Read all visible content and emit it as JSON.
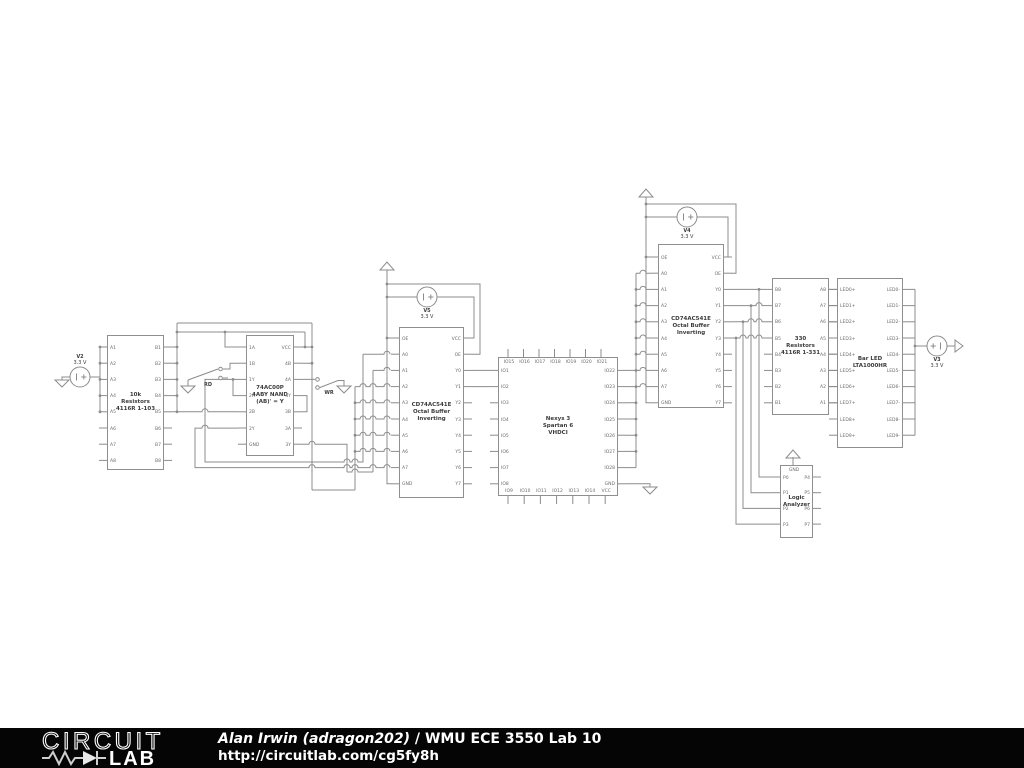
{
  "meta": {
    "background": "#ffffff",
    "wire_color": "#8c8c8c",
    "text_color": "#3c3c3c",
    "footer_bg": "#050505"
  },
  "footer": {
    "logo_top": "CIRCUIT",
    "logo_bottom": "LAB",
    "author": "Alan Irwin (adragon202)",
    "separator": " / ",
    "title": "WMU ECE 3550 Lab 10",
    "url": "http://circuitlab.com/cg5fy8h"
  },
  "sources": [
    {
      "id": "v2",
      "name": "V2",
      "value": "3.3 V",
      "cx": 80,
      "cy": 377,
      "label_side": "above",
      "plus": "right"
    },
    {
      "id": "v5",
      "name": "V5",
      "value": "3.3 V",
      "cx": 427,
      "cy": 297,
      "label_side": "below",
      "plus": "right"
    },
    {
      "id": "v4",
      "name": "V4",
      "value": "3.3 V",
      "cx": 687,
      "cy": 217,
      "label_side": "below",
      "plus": "right"
    },
    {
      "id": "v3",
      "name": "V3",
      "value": "3.3 V",
      "cx": 937,
      "cy": 346,
      "label_side": "below",
      "plus": "left"
    }
  ],
  "switches": [
    {
      "id": "rd",
      "label": "RD",
      "x": 208,
      "y": 382
    },
    {
      "id": "wr",
      "label": "WR",
      "x": 329,
      "y": 390
    }
  ],
  "components": [
    {
      "id": "res10k",
      "box": [
        107,
        335,
        57,
        135
      ],
      "title": [
        "10k",
        "Resistors",
        "4116R 1-103"
      ],
      "left": {
        "labels": [
          "A1",
          "A2",
          "A3",
          "A4",
          "A5",
          "A6",
          "A7",
          "A8"
        ],
        "start": 347,
        "sp": 16.2
      },
      "right": {
        "labels": [
          "B1",
          "B2",
          "B3",
          "B4",
          "B5",
          "B6",
          "B7",
          "B8"
        ],
        "start": 347,
        "sp": 16.2
      }
    },
    {
      "id": "nand",
      "box": [
        246,
        335,
        48,
        121
      ],
      "title": [
        "74AC00P",
        "4ABY NAND",
        "(AB)' = Y"
      ],
      "left": {
        "labels": [
          "1A",
          "1B",
          "1Y",
          "2A",
          "2B",
          "2Y",
          "GND"
        ],
        "start": 347,
        "sp": 16.2
      },
      "right": {
        "labels": [
          "VCC",
          "4B",
          "4A",
          "4Y",
          "3B",
          "3A",
          "3Y"
        ],
        "start": 347,
        "sp": 16.2
      }
    },
    {
      "id": "buf1",
      "box": [
        399,
        327,
        65,
        171
      ],
      "title": [
        "CD74AC541E",
        "Octal Buffer",
        "Inverting"
      ],
      "left": {
        "labels": [
          "OE",
          "A0",
          "A1",
          "A2",
          "A3",
          "A4",
          "A5",
          "A6",
          "A7",
          "GND"
        ],
        "start": 338,
        "sp": 16.2
      },
      "right": {
        "labels": [
          "VCC",
          "OE",
          "Y0",
          "Y1",
          "Y2",
          "Y3",
          "Y4",
          "Y5",
          "Y6",
          "Y7"
        ],
        "start": 338,
        "sp": 16.2
      }
    },
    {
      "id": "nexys",
      "box": [
        498,
        357,
        120,
        139
      ],
      "title": [
        "Nexys 3",
        "Spartan 6",
        "VHDCI"
      ],
      "left": {
        "labels": [
          "IO1",
          "IO2",
          "IO3",
          "IO4",
          "IO5",
          "IO6",
          "IO7",
          "IO8"
        ],
        "start": 370.4,
        "sp": 16.2
      },
      "right": {
        "labels": [
          "IO22",
          "IO23",
          "IO24",
          "IO25",
          "IO26",
          "IO27",
          "IO28",
          "GND"
        ],
        "start": 370.4,
        "sp": 16.2
      },
      "top": {
        "labels": [
          "IO15",
          "IO16",
          "IO17",
          "IO18",
          "IO19",
          "IO20",
          "IO21"
        ],
        "start": 508,
        "sp": 15.5
      },
      "bottom": {
        "labels": [
          "IO9",
          "IO10",
          "IO11",
          "IO12",
          "IO13",
          "IO14",
          "VCC"
        ],
        "start": 508,
        "sp": 16.2
      }
    },
    {
      "id": "buf2",
      "box": [
        658,
        244,
        66,
        164
      ],
      "title": [
        "CD74AC541E",
        "Octal Buffer",
        "Inverting"
      ],
      "left": {
        "labels": [
          "OE",
          "A0",
          "A1",
          "A2",
          "A3",
          "A4",
          "A5",
          "A6",
          "A7",
          "GND"
        ],
        "start": 257,
        "sp": 16.2
      },
      "right": {
        "labels": [
          "VCC",
          "OE",
          "Y0",
          "Y1",
          "Y2",
          "Y3",
          "Y4",
          "Y5",
          "Y6",
          "Y7"
        ],
        "start": 257,
        "sp": 16.2
      }
    },
    {
      "id": "res330",
      "box": [
        772,
        278,
        57,
        137
      ],
      "title": [
        "330",
        "Resistors",
        "4116R 1-331"
      ],
      "left": {
        "labels": [
          "B8",
          "B7",
          "B6",
          "B5",
          "B4",
          "B3",
          "B2",
          "B1"
        ],
        "start": 289.4,
        "sp": 16.2
      },
      "right": {
        "labels": [
          "A8",
          "A7",
          "A6",
          "A5",
          "A4",
          "A3",
          "A2",
          "A1"
        ],
        "start": 289.4,
        "sp": 16.2
      }
    },
    {
      "id": "barled",
      "box": [
        837,
        278,
        66,
        170
      ],
      "title": [
        "Bar LED",
        "LTA1000HR"
      ],
      "left": {
        "labels": [
          "LED0+",
          "LED1+",
          "LED2+",
          "LED3+",
          "LED4+",
          "LED5+",
          "LED6+",
          "LED7+",
          "LED8+",
          "LED9+"
        ],
        "start": 289.4,
        "sp": 16.2
      },
      "right": {
        "labels": [
          "LED0-",
          "LED1-",
          "LED2-",
          "LED3-",
          "LED4-",
          "LED5-",
          "LED6-",
          "LED7-",
          "LED8-",
          "LED9-"
        ],
        "start": 289.4,
        "sp": 16.2
      }
    },
    {
      "id": "la",
      "box": [
        780,
        465,
        33,
        73
      ],
      "title": [
        "Logic",
        "Analyzer"
      ],
      "left": {
        "labels": [
          "P0",
          "P1",
          "P2",
          "P3"
        ],
        "start": 477,
        "sp": 15.7
      },
      "right": {
        "labels": [
          "P4",
          "P5",
          "P6",
          "P7"
        ],
        "start": 477,
        "sp": 15.7
      },
      "top": {
        "labels": [
          "GND"
        ],
        "start": 793,
        "sp": 0
      }
    }
  ]
}
